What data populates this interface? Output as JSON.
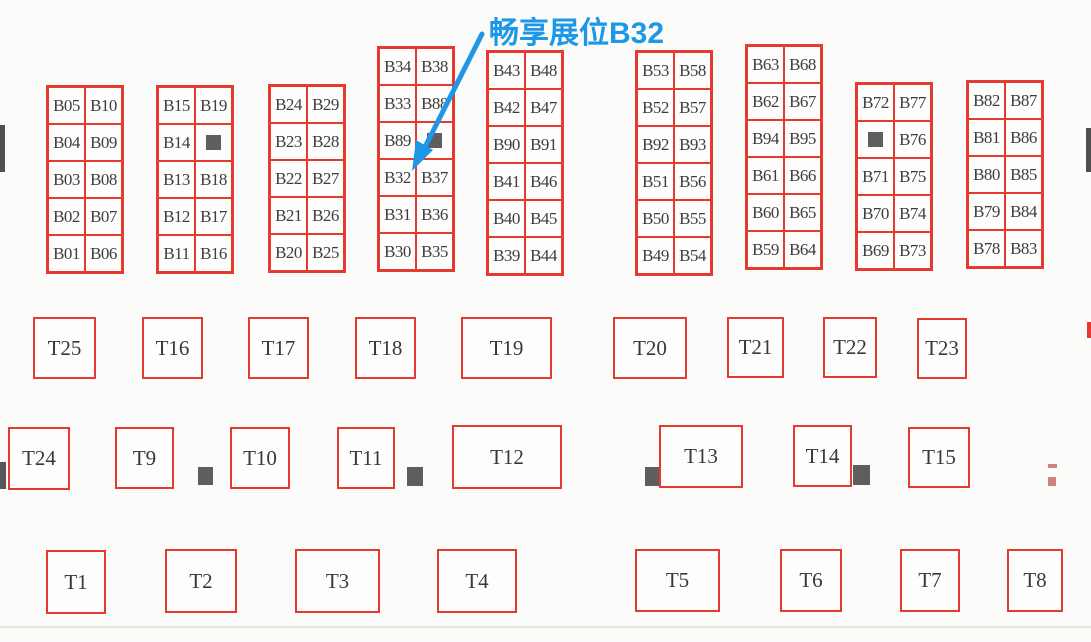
{
  "layout": {
    "canvas_w": 1091,
    "canvas_h": 642,
    "cell_w": 37,
    "cell_h": 37,
    "bg_color": "#fbfbfa",
    "booth_border_color": "#e63a30",
    "booth_text_color": "#413c3c",
    "square_color": "#5e5e5e",
    "bottom_line_y": 626,
    "bottom_line_color": "#e6e6e3"
  },
  "markers": {
    "square_token": "[sq]"
  },
  "annotation": {
    "label": "畅享展位B32",
    "color": "#1e97e8",
    "text_x": 489,
    "text_y": 8,
    "points_to": "B32",
    "arrow_line": {
      "x1": 482,
      "y1": 34,
      "x2": 425,
      "y2": 147
    },
    "arrow_head_points": "412,171 416,140 433,150",
    "arrow_width": 5
  },
  "booth_columns": [
    {
      "x": 46,
      "y": 85,
      "rows": [
        [
          "B05",
          "B10"
        ],
        [
          "B04",
          "B09"
        ],
        [
          "B03",
          "B08"
        ],
        [
          "B02",
          "B07"
        ],
        [
          "B01",
          "B06"
        ]
      ]
    },
    {
      "x": 156,
      "y": 85,
      "rows": [
        [
          "B15",
          "B19"
        ],
        [
          "B14",
          "[sq]"
        ],
        [
          "B13",
          "B18"
        ],
        [
          "B12",
          "B17"
        ],
        [
          "B11",
          "B16"
        ]
      ]
    },
    {
      "x": 268,
      "y": 84,
      "rows": [
        [
          "B24",
          "B29"
        ],
        [
          "B23",
          "B28"
        ],
        [
          "B22",
          "B27"
        ],
        [
          "B21",
          "B26"
        ],
        [
          "B20",
          "B25"
        ]
      ]
    },
    {
      "x": 377,
      "y": 46,
      "rows": [
        [
          "B34",
          "B38"
        ],
        [
          "B33",
          "B88"
        ],
        [
          "B89",
          "[sq]"
        ],
        [
          "B32",
          "B37"
        ],
        [
          "B31",
          "B36"
        ],
        [
          "B30",
          "B35"
        ]
      ]
    },
    {
      "x": 486,
      "y": 50,
      "rows": [
        [
          "B43",
          "B48"
        ],
        [
          "B42",
          "B47"
        ],
        [
          "B90",
          "B91"
        ],
        [
          "B41",
          "B46"
        ],
        [
          "B40",
          "B45"
        ],
        [
          "B39",
          "B44"
        ]
      ]
    },
    {
      "x": 635,
      "y": 50,
      "rows": [
        [
          "B53",
          "B58"
        ],
        [
          "B52",
          "B57"
        ],
        [
          "B92",
          "B93"
        ],
        [
          "B51",
          "B56"
        ],
        [
          "B50",
          "B55"
        ],
        [
          "B49",
          "B54"
        ]
      ]
    },
    {
      "x": 745,
      "y": 44,
      "rows": [
        [
          "B63",
          "B68"
        ],
        [
          "B62",
          "B67"
        ],
        [
          "B94",
          "B95"
        ],
        [
          "B61",
          "B66"
        ],
        [
          "B60",
          "B65"
        ],
        [
          "B59",
          "B64"
        ]
      ]
    },
    {
      "x": 855,
      "y": 82,
      "rows": [
        [
          "B72",
          "B77"
        ],
        [
          "[sq]",
          "B76"
        ],
        [
          "B71",
          "B75"
        ],
        [
          "B70",
          "B74"
        ],
        [
          "B69",
          "B73"
        ]
      ]
    },
    {
      "x": 966,
      "y": 80,
      "rows": [
        [
          "B82",
          "B87"
        ],
        [
          "B81",
          "B86"
        ],
        [
          "B80",
          "B85"
        ],
        [
          "B79",
          "B84"
        ],
        [
          "B78",
          "B83"
        ]
      ]
    }
  ],
  "t_booths": [
    {
      "label": "T25",
      "x": 33,
      "y": 317,
      "w": 63,
      "h": 62
    },
    {
      "label": "T16",
      "x": 142,
      "y": 317,
      "w": 61,
      "h": 62
    },
    {
      "label": "T17",
      "x": 248,
      "y": 317,
      "w": 61,
      "h": 62
    },
    {
      "label": "T18",
      "x": 355,
      "y": 317,
      "w": 61,
      "h": 62
    },
    {
      "label": "T19",
      "x": 461,
      "y": 317,
      "w": 91,
      "h": 62
    },
    {
      "label": "T20",
      "x": 613,
      "y": 317,
      "w": 74,
      "h": 62
    },
    {
      "label": "T21",
      "x": 727,
      "y": 317,
      "w": 57,
      "h": 61
    },
    {
      "label": "T22",
      "x": 823,
      "y": 317,
      "w": 54,
      "h": 61
    },
    {
      "label": "T23",
      "x": 917,
      "y": 318,
      "w": 50,
      "h": 61
    },
    {
      "label": "T24",
      "x": 8,
      "y": 427,
      "w": 62,
      "h": 63
    },
    {
      "label": "T9",
      "x": 115,
      "y": 427,
      "w": 59,
      "h": 62
    },
    {
      "label": "T10",
      "x": 230,
      "y": 427,
      "w": 60,
      "h": 62
    },
    {
      "label": "T11",
      "x": 337,
      "y": 427,
      "w": 58,
      "h": 62
    },
    {
      "label": "T12",
      "x": 452,
      "y": 425,
      "w": 110,
      "h": 64
    },
    {
      "label": "T13",
      "x": 659,
      "y": 425,
      "w": 84,
      "h": 63
    },
    {
      "label": "T14",
      "x": 793,
      "y": 425,
      "w": 59,
      "h": 62
    },
    {
      "label": "T15",
      "x": 908,
      "y": 427,
      "w": 62,
      "h": 61
    },
    {
      "label": "T1",
      "x": 46,
      "y": 550,
      "w": 60,
      "h": 64
    },
    {
      "label": "T2",
      "x": 165,
      "y": 549,
      "w": 72,
      "h": 64
    },
    {
      "label": "T3",
      "x": 295,
      "y": 549,
      "w": 85,
      "h": 64
    },
    {
      "label": "T4",
      "x": 437,
      "y": 549,
      "w": 80,
      "h": 64
    },
    {
      "label": "T5",
      "x": 635,
      "y": 549,
      "w": 85,
      "h": 63
    },
    {
      "label": "T6",
      "x": 780,
      "y": 549,
      "w": 62,
      "h": 63
    },
    {
      "label": "T7",
      "x": 900,
      "y": 549,
      "w": 60,
      "h": 63
    },
    {
      "label": "T8",
      "x": 1007,
      "y": 549,
      "w": 56,
      "h": 63
    }
  ],
  "gray_squares": [
    {
      "x": 198,
      "y": 467,
      "w": 15,
      "h": 18
    },
    {
      "x": 407,
      "y": 467,
      "w": 16,
      "h": 19
    },
    {
      "x": 645,
      "y": 467,
      "w": 14,
      "h": 19
    },
    {
      "x": 853,
      "y": 465,
      "w": 17,
      "h": 20
    }
  ],
  "edge_fragments": [
    {
      "name": "left-edge-dark-bar",
      "x": 0,
      "y": 125,
      "w": 5,
      "h": 47,
      "color": "#4f4f4f"
    },
    {
      "name": "right-edge-dark-bar",
      "x": 1086,
      "y": 128,
      "w": 5,
      "h": 44,
      "color": "#4f4f4f"
    },
    {
      "name": "left-edge-square-fragment",
      "x": 0,
      "y": 462,
      "w": 6,
      "h": 27,
      "color": "#565656"
    },
    {
      "name": "right-edge-booth-fragment",
      "x": 1087,
      "y": 322,
      "w": 4,
      "h": 16,
      "color": "#e63a30"
    },
    {
      "name": "right-faint-mark-top",
      "x": 1048,
      "y": 464,
      "w": 9,
      "h": 4,
      "color": "#cf837c"
    },
    {
      "name": "right-faint-mark-bottom",
      "x": 1048,
      "y": 477,
      "w": 8,
      "h": 9,
      "color": "#cf837c"
    }
  ]
}
